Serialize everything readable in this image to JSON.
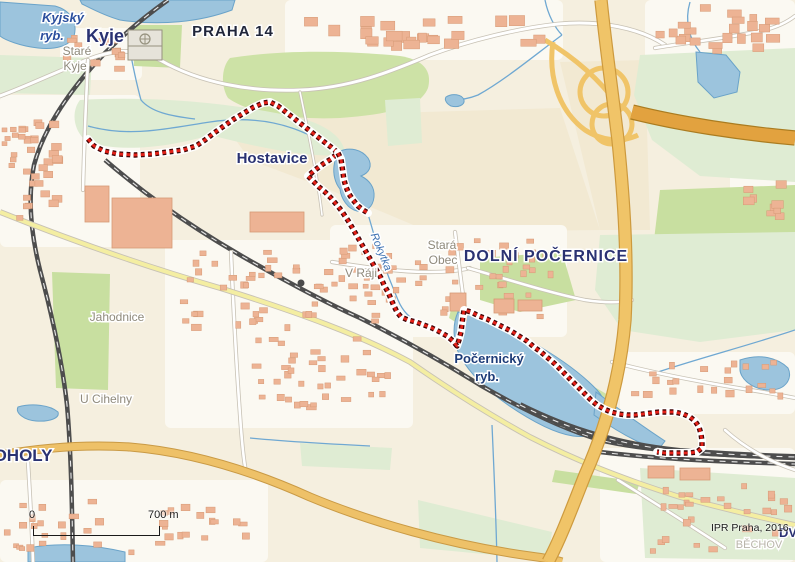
{
  "map": {
    "attribution": "IPR Praha, 2016",
    "scale_bar": {
      "zero_label": "0",
      "distance_label": "700 m"
    },
    "colors": {
      "base": "#f5efdf",
      "urban": "#fbf9f2",
      "field": "#f2e9d2",
      "green_bright": "#cde2a6",
      "green_pale": "#dfecd3",
      "green_mid": "#c8dfa0",
      "water_fill": "#9cc4dd",
      "water_stroke": "#6aa3c9",
      "stream": "#6fa8d2",
      "road_casing": "#c8c2b5",
      "road_fill": "#ffffff",
      "road_yellow": "#f4eea2",
      "road_orange": "#eec168",
      "road_orange_casing": "#c99a45",
      "motorway": "#f0c468",
      "motorway_casing": "#cd9a3e",
      "motorway_dark": "#e2a23f",
      "motorway_dark_casing": "#ab7c20",
      "railway": "#4d4d4d",
      "railway_dash": "#e8e8e8",
      "building": "#edb394",
      "building_stroke": "#d69a76",
      "route_red": "#e32119",
      "route_dark": "#420606",
      "route_halo": "#ffffff",
      "label_district": "#2a3272",
      "label_city": "#20263a",
      "label_locality": "#8f8a7c",
      "label_locality_light": "#b9b5aa",
      "label_water": "#2b4f9e",
      "label_water2": "#1d3c78",
      "label_stream": "#3a6fb0"
    },
    "labels": [
      {
        "t": "Kyje",
        "x": 105,
        "y": 42,
        "s": 18,
        "c": "district"
      },
      {
        "t": "Kyjský",
        "x": 63,
        "y": 22,
        "s": 13,
        "c": "water"
      },
      {
        "t": "ryb.",
        "x": 52,
        "y": 40,
        "s": 13,
        "c": "water"
      },
      {
        "t": "Staré",
        "x": 77,
        "y": 55,
        "s": 12,
        "c": "locality"
      },
      {
        "t": "Kyje",
        "x": 75,
        "y": 70,
        "s": 12,
        "c": "locality"
      },
      {
        "t": "PRAHA 14",
        "x": 233,
        "y": 36,
        "s": 15,
        "c": "city",
        "spacing": 1
      },
      {
        "t": "Hostavice",
        "x": 272,
        "y": 163,
        "s": 15,
        "c": "district"
      },
      {
        "t": "Stará",
        "x": 442,
        "y": 249,
        "s": 12,
        "c": "locality"
      },
      {
        "t": "Obec",
        "x": 443,
        "y": 264,
        "s": 12,
        "c": "locality"
      },
      {
        "t": "DOLNÍ POČERNICE",
        "x": 546,
        "y": 261,
        "s": 16,
        "c": "district",
        "spacing": 1
      },
      {
        "t": "V Ráji",
        "x": 361,
        "y": 277,
        "s": 12,
        "c": "locality"
      },
      {
        "t": "Jahodnice",
        "x": 117,
        "y": 321,
        "s": 12,
        "c": "locality"
      },
      {
        "t": "U Cihelny",
        "x": 106,
        "y": 403,
        "s": 12,
        "c": "locality"
      },
      {
        "t": "OHOLY",
        "x": 23,
        "y": 461,
        "s": 17,
        "c": "district"
      },
      {
        "t": "Počernický",
        "x": 489,
        "y": 363,
        "s": 13,
        "c": "water2"
      },
      {
        "t": "ryb.",
        "x": 487,
        "y": 381,
        "s": 13,
        "c": "water2"
      },
      {
        "t": "Rokytka",
        "x": 378,
        "y": 253,
        "s": 11,
        "c": "stream",
        "rot": 68
      },
      {
        "t": "DV",
        "x": 788,
        "y": 537,
        "s": 13,
        "c": "district"
      },
      {
        "t": "BĚCHOV",
        "x": 759,
        "y": 548,
        "s": 11,
        "c": "locality_light"
      }
    ],
    "route": {
      "main": [
        [
          88,
          139
        ],
        [
          94,
          146
        ],
        [
          104,
          151
        ],
        [
          118,
          154
        ],
        [
          135,
          155
        ],
        [
          152,
          154
        ],
        [
          168,
          152
        ],
        [
          183,
          150
        ],
        [
          196,
          146
        ],
        [
          205,
          140
        ],
        [
          214,
          133
        ],
        [
          224,
          126
        ],
        [
          234,
          119
        ],
        [
          244,
          113
        ],
        [
          254,
          107
        ],
        [
          263,
          103
        ],
        [
          270,
          102
        ],
        [
          278,
          106
        ],
        [
          287,
          113
        ],
        [
          296,
          120
        ],
        [
          305,
          127
        ],
        [
          314,
          134
        ],
        [
          323,
          141
        ],
        [
          331,
          147
        ],
        [
          338,
          153
        ],
        [
          331,
          159
        ],
        [
          323,
          164
        ],
        [
          315,
          170
        ],
        [
          308,
          176
        ],
        [
          313,
          181
        ],
        [
          319,
          187
        ],
        [
          325,
          192
        ],
        [
          331,
          198
        ],
        [
          336,
          204
        ],
        [
          341,
          210
        ],
        [
          345,
          216
        ],
        [
          349,
          222
        ],
        [
          353,
          229
        ],
        [
          357,
          236
        ],
        [
          361,
          243
        ],
        [
          365,
          250
        ],
        [
          369,
          257
        ],
        [
          373,
          264
        ],
        [
          377,
          271
        ],
        [
          381,
          278
        ],
        [
          384,
          285
        ],
        [
          388,
          292
        ],
        [
          391,
          299
        ],
        [
          394,
          306
        ],
        [
          397,
          312
        ],
        [
          401,
          317
        ],
        [
          408,
          320
        ],
        [
          416,
          322
        ],
        [
          424,
          325
        ],
        [
          432,
          328
        ],
        [
          440,
          332
        ],
        [
          447,
          336
        ],
        [
          453,
          341
        ],
        [
          457,
          346
        ],
        [
          459,
          340
        ],
        [
          461,
          332
        ],
        [
          462,
          324
        ],
        [
          463,
          316
        ],
        [
          464,
          310
        ],
        [
          471,
          312
        ],
        [
          479,
          316
        ],
        [
          487,
          319
        ],
        [
          495,
          323
        ],
        [
          503,
          327
        ],
        [
          511,
          331
        ],
        [
          519,
          336
        ],
        [
          527,
          341
        ],
        [
          534,
          347
        ],
        [
          541,
          352
        ],
        [
          548,
          358
        ],
        [
          555,
          364
        ],
        [
          561,
          370
        ],
        [
          567,
          376
        ],
        [
          573,
          382
        ],
        [
          579,
          388
        ],
        [
          585,
          394
        ],
        [
          591,
          400
        ],
        [
          597,
          405
        ],
        [
          604,
          409
        ],
        [
          611,
          412
        ],
        [
          619,
          414
        ],
        [
          627,
          415
        ],
        [
          635,
          415
        ],
        [
          643,
          414
        ],
        [
          651,
          413
        ],
        [
          659,
          412
        ],
        [
          667,
          412
        ],
        [
          675,
          412
        ],
        [
          683,
          414
        ],
        [
          690,
          417
        ],
        [
          695,
          421
        ],
        [
          699,
          427
        ],
        [
          701,
          434
        ],
        [
          702,
          441
        ],
        [
          702,
          448
        ],
        [
          697,
          452
        ],
        [
          689,
          453
        ],
        [
          681,
          453
        ],
        [
          673,
          453
        ],
        [
          665,
          453
        ],
        [
          657,
          452
        ]
      ],
      "spur": [
        [
          338,
          153
        ],
        [
          341,
          159
        ],
        [
          342,
          166
        ],
        [
          343,
          173
        ],
        [
          344,
          180
        ],
        [
          346,
          187
        ],
        [
          349,
          194
        ],
        [
          353,
          200
        ],
        [
          358,
          206
        ],
        [
          363,
          210
        ],
        [
          368,
          213
        ]
      ]
    },
    "urban_zones": [
      {
        "x": 0,
        "y": 95,
        "w": 140,
        "h": 152
      },
      {
        "x": 60,
        "y": 28,
        "w": 82,
        "h": 52
      },
      {
        "x": 285,
        "y": 0,
        "w": 278,
        "h": 60
      },
      {
        "x": 645,
        "y": 0,
        "w": 150,
        "h": 62
      },
      {
        "x": 165,
        "y": 240,
        "w": 248,
        "h": 188
      },
      {
        "x": 330,
        "y": 225,
        "w": 112,
        "h": 112
      },
      {
        "x": 415,
        "y": 225,
        "w": 152,
        "h": 112
      },
      {
        "x": 620,
        "y": 352,
        "w": 175,
        "h": 62
      },
      {
        "x": 600,
        "y": 448,
        "w": 195,
        "h": 114
      },
      {
        "x": 0,
        "y": 480,
        "w": 268,
        "h": 82
      },
      {
        "x": 730,
        "y": 170,
        "w": 65,
        "h": 70
      }
    ],
    "fields": [
      {
        "d": "M220,118 L560,108 L600,230 L430,232 L330,190 L250,160 Z"
      },
      {
        "d": "M560,62 L645,60 L650,230 L600,230 Z"
      }
    ],
    "greens": [
      {
        "d": "M230,58 C280,50 340,50 400,56 C425,60 432,72 428,88 C420,108 390,114 340,118 C295,120 250,114 228,98 C220,85 222,66 230,58 Z",
        "f": "bright"
      },
      {
        "d": "M80,100 C150,96 230,102 300,118 C330,126 345,140 345,155 C310,158 260,148 210,135 C160,150 110,152 85,140 C72,128 72,110 80,100 Z",
        "f": "pale"
      },
      {
        "d": "M0,55 L92,58 L90,95 L0,93 Z",
        "f": "pale"
      },
      {
        "d": "M132,25 L182,25 L180,68 L134,66 Z",
        "f": "mid"
      },
      {
        "d": "M640,55 L795,48 L795,182 L700,176 L652,140 L634,95 Z",
        "f": "pale"
      },
      {
        "d": "M660,190 L795,185 L795,292 L680,286 L654,240 Z",
        "f": "mid"
      },
      {
        "d": "M600,235 L795,232 L795,330 L700,342 L622,330 L595,290 Z",
        "f": "pale"
      },
      {
        "d": "M480,258 L562,252 L576,300 L520,312 L480,300 Z",
        "f": "mid"
      },
      {
        "d": "M385,100 L420,98 L422,143 L388,146 Z",
        "f": "pale"
      },
      {
        "d": "M452,305 L610,396 L613,418 L588,414 L468,330 L449,318 Z",
        "f": "bright"
      },
      {
        "d": "M52,272 L110,274 L108,390 L56,388 Z",
        "f": "mid"
      },
      {
        "d": "M300,443 L392,448 L390,470 L302,466 Z",
        "f": "pale"
      },
      {
        "d": "M418,500 L552,532 L548,560 L420,548 Z",
        "f": "pale"
      },
      {
        "d": "M640,468 L795,478 L795,560 L645,558 Z",
        "f": "pale"
      },
      {
        "d": "M555,470 L640,482 L636,494 L552,482 Z",
        "f": "mid"
      }
    ],
    "water": [
      {
        "d": "M0,2 L55,6 C70,10 78,22 74,36 C70,46 55,50 38,48 C20,46 5,40 0,36 Z"
      },
      {
        "d": "M80,0 L235,0 L232,10 C200,22 160,26 120,20 C105,16 90,8 82,4 Z"
      },
      {
        "d": "M338,152 C350,146 362,150 368,158 C373,166 369,173 361,176 C369,180 375,187 374,197 C373,207 366,213 357,211 C348,209 341,199 340,189 C335,183 333,174 334,166 C335,159 336,155 338,152 Z"
      },
      {
        "d": "M446,97 C452,93 462,94 464,100 C465,105 458,108 451,106 C447,104 444,100 446,97 Z"
      },
      {
        "d": "M696,52 L726,55 L740,72 L737,92 L714,98 L698,82 Z"
      },
      {
        "d": "M458,312 C480,318 505,327 530,341 C555,355 580,372 597,390 C606,400 610,412 606,424 C601,434 588,438 573,436 C553,433 530,420 508,405 C488,391 470,374 460,356 C453,342 452,325 458,312 Z"
      },
      {
        "d": "M596,392 C620,410 645,428 665,441 L658,450 C635,442 612,428 594,415 Z"
      },
      {
        "d": "M740,360 C760,353 778,358 788,368 C793,378 786,390 770,390 C752,390 739,378 740,368 Z"
      },
      {
        "d": "M18,407 C32,403 50,405 58,412 C60,418 50,422 36,421 C24,420 15,413 18,407 Z"
      },
      {
        "d": "M28,548 C60,542 95,545 125,552 L125,562 L28,562 Z"
      }
    ],
    "streams": [
      {
        "d": "M128,40 C132,62 136,82 141,100 C151,112 170,116 195,119"
      },
      {
        "d": "M88,126 C130,138 170,128 210,122 C250,116 285,122 315,138 C325,144 332,148 337,152"
      },
      {
        "d": "M368,214 C375,240 386,272 398,300 C403,312 410,318 420,324 C435,330 448,336 456,344"
      },
      {
        "d": "M562,35 C535,55 505,80 478,95 C468,99 460,100 452,100"
      },
      {
        "d": "M545,0 C548,15 555,28 562,35"
      },
      {
        "d": "M795,330 C750,345 700,358 658,372"
      },
      {
        "d": "M492,425 C494,470 496,515 497,562"
      },
      {
        "d": "M250,438 C290,442 330,444 370,446"
      },
      {
        "d": "M690,2 C684,22 690,40 700,52"
      }
    ],
    "railways": [
      {
        "d": "M168,0 C140,20 110,45 85,75 C60,105 42,135 34,165 C28,195 30,230 40,270 C52,315 62,360 67,405 C71,450 72,505 73,562",
        "w": 4.5
      },
      {
        "d": "M105,160 C140,190 180,220 240,255 C280,278 320,300 360,318 C400,338 440,360 480,385 C520,408 560,428 600,440 C650,452 720,455 795,458",
        "w": 4.5
      },
      {
        "d": "M520,405 C570,430 620,445 680,451 C720,454 760,456 795,457",
        "w": 6
      },
      {
        "d": "M600,452 C650,458 700,461 795,464",
        "w": 4.5
      }
    ],
    "roads_white": [
      {
        "d": "M0,96 C30,85 60,70 92,58 C120,48 140,50 160,60 C200,83 250,92 300,90 C350,88 390,72 430,55 C470,40 520,28 558,24 C600,20 640,28 665,45",
        "w": 3
      },
      {
        "d": "M231,252 C233,300 236,360 240,415 C242,445 244,462 246,472",
        "w": 2.6
      },
      {
        "d": "M88,60 C86,100 84,150 83,190",
        "w": 2.6
      },
      {
        "d": "M332,262 C370,268 400,272 430,272 C450,272 462,270 470,268",
        "w": 2.6
      },
      {
        "d": "M455,232 C459,262 462,292 466,315",
        "w": 2.6
      },
      {
        "d": "M468,268 C510,280 550,293 585,300 C605,303 620,303 632,300",
        "w": 2.6
      },
      {
        "d": "M612,362 C650,372 700,382 750,390 C770,393 785,396 795,398",
        "w": 2.6
      },
      {
        "d": "M618,480 C650,500 690,525 725,548",
        "w": 2.6
      },
      {
        "d": "M725,430 C745,448 770,462 795,470",
        "w": 2.6
      },
      {
        "d": "M655,48 C690,42 730,38 765,30 C780,26 790,20 795,16",
        "w": 2.6
      },
      {
        "d": "M28,462 C30,495 32,530 33,562",
        "w": 2.6
      },
      {
        "d": "M300,92 C310,140 318,180 322,215",
        "w": 1.6
      }
    ],
    "roads_yellow": [
      {
        "d": "M0,212 C70,240 140,265 220,288 C300,313 360,335 410,362 C450,390 490,415 530,437 C575,460 620,478 680,497 C740,513 795,525 795,525",
        "w": 4
      }
    ],
    "roads_orange": [
      {
        "d": "M0,455 C40,448 85,444 130,447 C190,452 250,470 310,497 C370,522 450,545 530,556 C545,558 555,560 562,562",
        "w": 7
      }
    ],
    "motorway": [
      {
        "d": "M601,0 C605,40 612,90 618,140 C624,200 628,260 625,320 C620,380 605,430 585,475 C572,508 560,540 548,562",
        "w": 11,
        "t": "mw"
      },
      {
        "d": "M632,112 C680,124 740,133 795,138",
        "w": 13,
        "t": "mwdark"
      }
    ],
    "ramps": [
      {
        "d": "M604,68 C618,68 628,80 628,92 C628,106 616,116 604,116 C590,116 580,104 580,92 C580,80 590,68 604,68 Z"
      },
      {
        "d": "M612,104 C624,104 632,114 632,124 C632,136 622,144 612,144 C600,144 592,134 592,124 C592,114 600,104 612,104 Z"
      },
      {
        "d": "M553,42 C548,75 558,110 585,130 C602,141 622,143 638,135"
      },
      {
        "d": "M545,40 C575,58 600,80 618,105"
      }
    ],
    "buildings_large": [
      {
        "x": 112,
        "y": 198,
        "w": 60,
        "h": 50
      },
      {
        "x": 85,
        "y": 186,
        "w": 24,
        "h": 36
      },
      {
        "x": 250,
        "y": 212,
        "w": 54,
        "h": 20
      },
      {
        "x": 494,
        "y": 299,
        "w": 20,
        "h": 14
      },
      {
        "x": 518,
        "y": 300,
        "w": 24,
        "h": 11
      },
      {
        "x": 450,
        "y": 293,
        "w": 16,
        "h": 18
      },
      {
        "x": 648,
        "y": 466,
        "w": 26,
        "h": 12
      },
      {
        "x": 680,
        "y": 468,
        "w": 30,
        "h": 12
      },
      {
        "x": 838,
        "y": 0,
        "w": 0,
        "h": 0
      }
    ],
    "school": {
      "x": 128,
      "y": 30,
      "w": 34,
      "h": 30
    },
    "building_zones": [
      {
        "x": 2,
        "y": 118,
        "w": 56,
        "h": 110,
        "n": 38,
        "s": 5
      },
      {
        "x": 62,
        "y": 32,
        "w": 70,
        "h": 40,
        "n": 14,
        "s": 5
      },
      {
        "x": 300,
        "y": 4,
        "w": 248,
        "h": 46,
        "n": 26,
        "s": 8
      },
      {
        "x": 652,
        "y": 4,
        "w": 138,
        "h": 50,
        "n": 22,
        "s": 7
      },
      {
        "x": 180,
        "y": 248,
        "w": 212,
        "h": 82,
        "n": 52,
        "s": 5
      },
      {
        "x": 235,
        "y": 335,
        "w": 158,
        "h": 78,
        "n": 38,
        "s": 5
      },
      {
        "x": 338,
        "y": 238,
        "w": 88,
        "h": 66,
        "n": 20,
        "s": 5
      },
      {
        "x": 425,
        "y": 238,
        "w": 128,
        "h": 82,
        "n": 32,
        "s": 5
      },
      {
        "x": 628,
        "y": 360,
        "w": 158,
        "h": 38,
        "n": 22,
        "s": 5
      },
      {
        "x": 645,
        "y": 482,
        "w": 146,
        "h": 72,
        "n": 28,
        "s": 5
      },
      {
        "x": 4,
        "y": 497,
        "w": 112,
        "h": 58,
        "n": 20,
        "s": 5
      },
      {
        "x": 128,
        "y": 504,
        "w": 122,
        "h": 52,
        "n": 18,
        "s": 5
      },
      {
        "x": 738,
        "y": 178,
        "w": 54,
        "h": 52,
        "n": 10,
        "s": 6
      }
    ]
  }
}
